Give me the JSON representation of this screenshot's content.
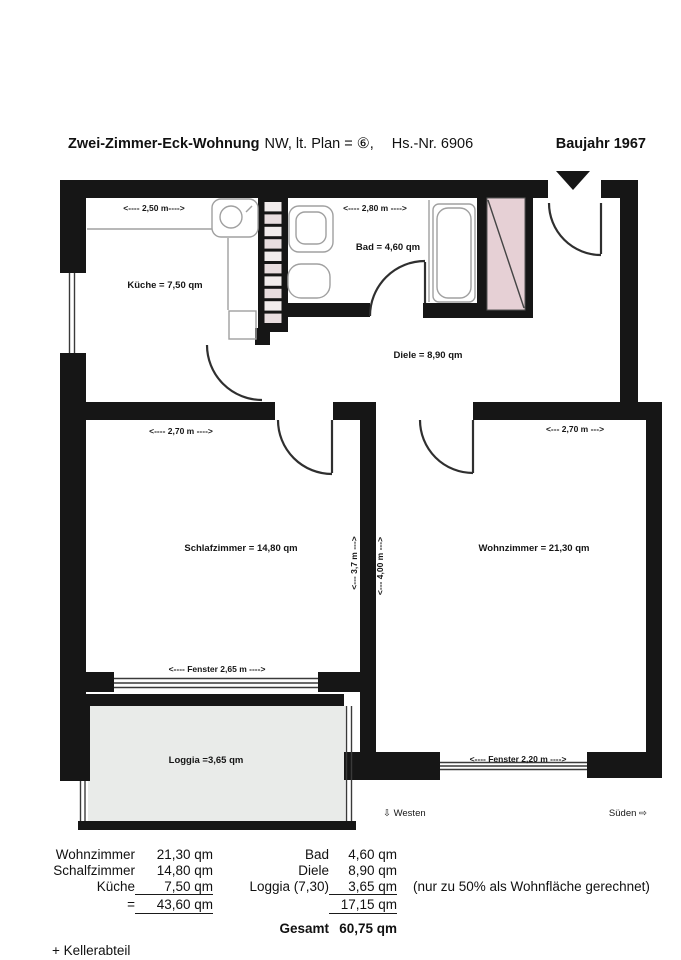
{
  "header": {
    "title": "Zwei-Zimmer-Eck-Wohnung",
    "subtitle": "NW, lt. Plan = ⑥,",
    "house_no": "Hs.-Nr. 6906",
    "year": "Baujahr 1967"
  },
  "plan": {
    "kueche_dim": "<---- 2,50 m---->",
    "bad_dim": "<---- 2,80 m ---->",
    "kueche": "Küche = 7,50 qm",
    "bad": "Bad = 4,60 qm",
    "diele": "Diele = 8,90 qm",
    "schlaf_dim": "<---- 2,70 m ---->",
    "wohn_dim": "<--- 2,70 m --->",
    "schlafzimmer": "Schlafzimmer = 14,80 qm",
    "wohnzimmer": "Wohnzimmer = 21,30 qm",
    "depth_37": "<--- 3,7 m --->",
    "depth_400": "<--- 4,00 m --->",
    "fenster_265": "<---- Fenster 2,65 m ---->",
    "loggia": "Loggia =3,65 qm",
    "fenster_220": "<---- Fenster 2,20 m ---->",
    "westen": "⇩ Westen",
    "sueden": "Süden ⇨"
  },
  "table": {
    "rows": [
      {
        "c1": "Wohnzimmer",
        "c2": "21,30 qm",
        "c3": "Bad",
        "c4": "4,60 qm",
        "c5": ""
      },
      {
        "c1": "Schalfzimmer",
        "c2": "14,80 qm",
        "c3": "Diele",
        "c4": "8,90 qm",
        "c5": ""
      },
      {
        "c1": "Küche",
        "c2": "7,50 qm",
        "c3": "Loggia (7,30)",
        "c4": "3,65 qm",
        "c5": "(nur zu 50% als Wohnfläche gerechnet)"
      },
      {
        "c1": "=",
        "c2": "43,60 qm",
        "c3": "",
        "c4": "17,15 qm",
        "c5": ""
      }
    ],
    "gesamt_label": "Gesamt",
    "gesamt_value": "60,75 qm",
    "keller": "+ Kellerabteil"
  },
  "colors": {
    "wall": "#161616",
    "shaft_pink": "#e6d0d5",
    "loggia_fill": "#e9ebe9",
    "shaft_square_a": "#f1ecec",
    "shaft_square_b": "#e8dddf"
  }
}
